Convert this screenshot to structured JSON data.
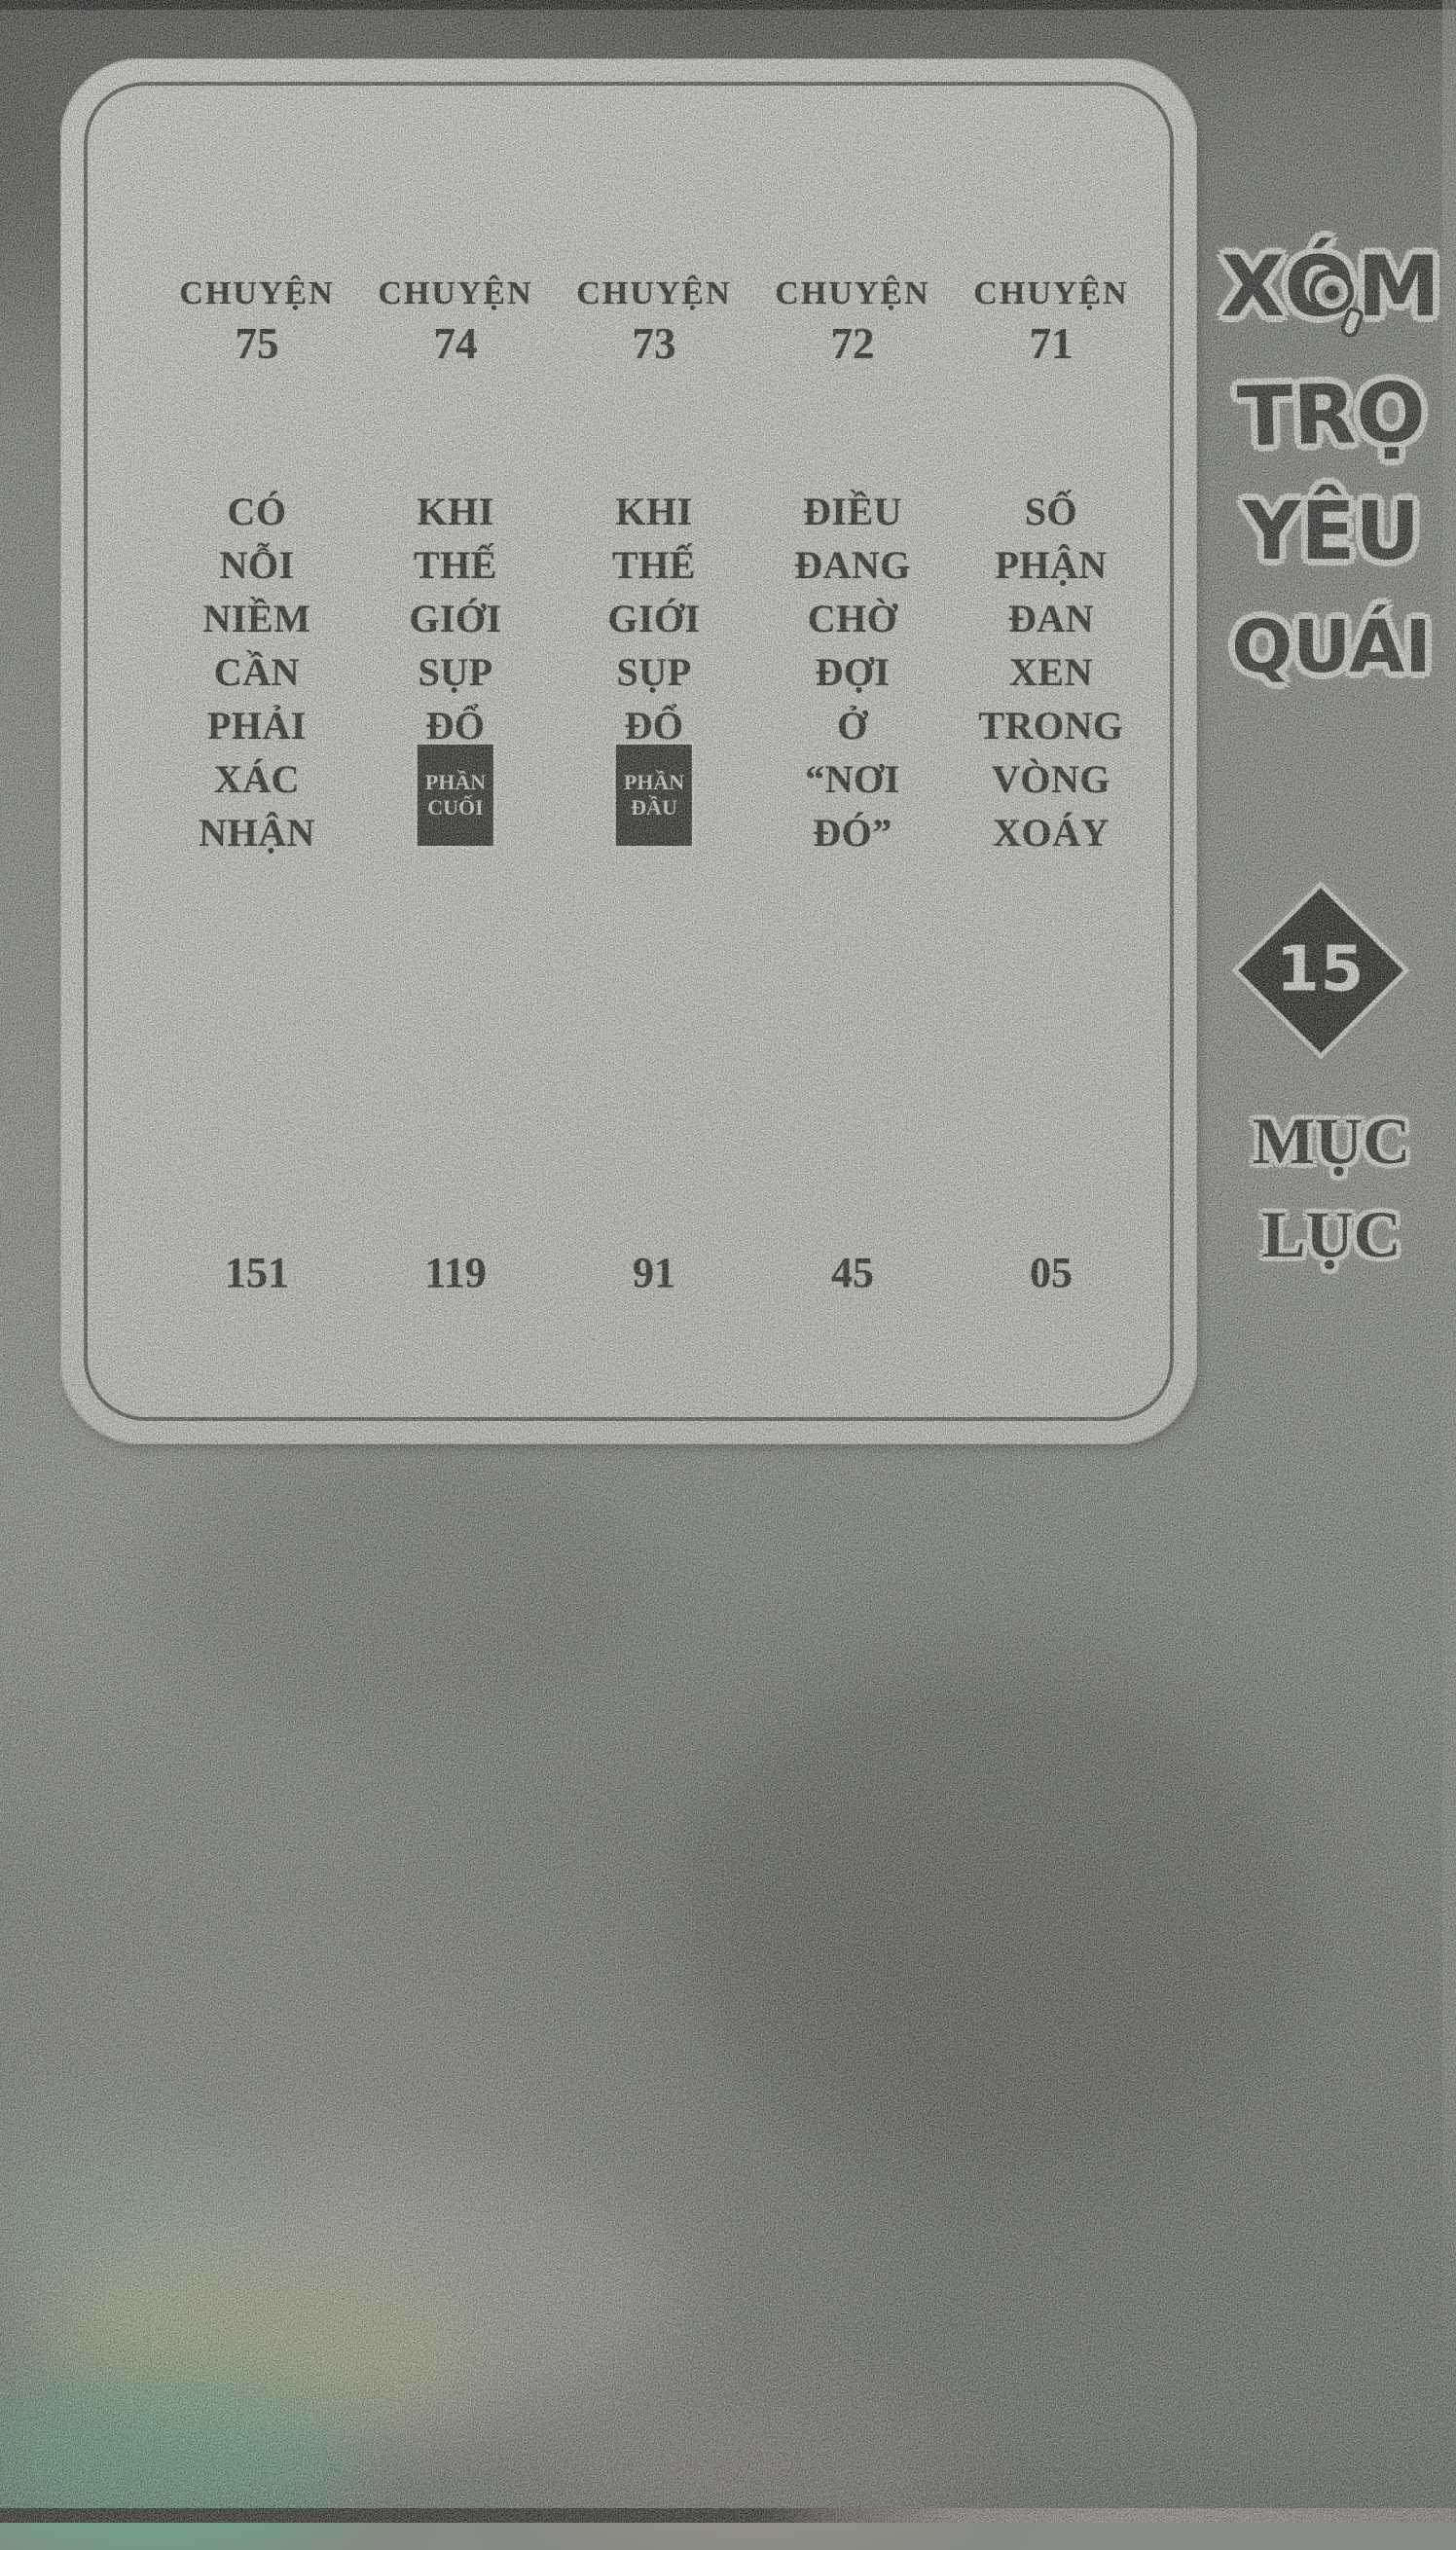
{
  "page": {
    "kind": "scanned manga table-of-contents page",
    "colors": {
      "paper": "#e7e5df",
      "ink": "#171511",
      "frame_line": "#4b4a43",
      "badge_bg": "#201e1b",
      "badge_text": "#f1eee7",
      "diamond_bg": "#151512",
      "halo_white": "#f2f1ea",
      "background_gray": "#8d928a",
      "scan_tint_green": "#58be8a"
    }
  },
  "toc": {
    "chapters": [
      {
        "label": "CHUYỆN",
        "number": "75",
        "title": "CÓ NỖI NIỀM CẦN PHẢI XÁC NHẬN",
        "title_lines": "CÓ\nNỖI\nNIỀM\nCẦN\nPHẢI\nXÁC\nNHẬN",
        "page": "151"
      },
      {
        "label": "CHUYỆN",
        "number": "74",
        "title": "KHI THẾ GIỚI SỤP ĐỔ",
        "title_lines": "KHI\nTHẾ\nGIỚI\nSỤP\nĐỔ",
        "badge": "PHẦN\nCUỐI",
        "page": "119"
      },
      {
        "label": "CHUYỆN",
        "number": "73",
        "title": "KHI THẾ GIỚI SỤP ĐỔ",
        "title_lines": "KHI\nTHẾ\nGIỚI\nSỤP\nĐỔ",
        "badge": "PHẦN\nĐẦU",
        "page": "91"
      },
      {
        "label": "CHUYỆN",
        "number": "72",
        "title": "ĐIỀU ĐANG CHỜ ĐỢI Ở “NƠI ĐÓ”",
        "title_lines": "ĐIỀU\nĐANG\nCHỜ\nĐỢI\nỞ\n“NƠI\nĐÓ”",
        "page": "45"
      },
      {
        "label": "CHUYỆN",
        "number": "71",
        "title": "SỐ PHẬN ĐAN XEN TRONG VÒNG XOÁY",
        "title_lines": "SỐ\nPHẬN\nĐAN\nXEN\nTRONG\nVÒNG\nXOÁY",
        "page": "05"
      }
    ]
  },
  "sidebar": {
    "series_title": "XÓM TRỌ YÊU QUÁI",
    "title_words": {
      "w1": "XÓM",
      "w2": "TRỌ",
      "w3": "YÊU",
      "w4": "QUÁI"
    },
    "volume_number": "15",
    "section_label": "MỤC LỤC",
    "section_label_lines": "MỤC\nLỤC"
  }
}
